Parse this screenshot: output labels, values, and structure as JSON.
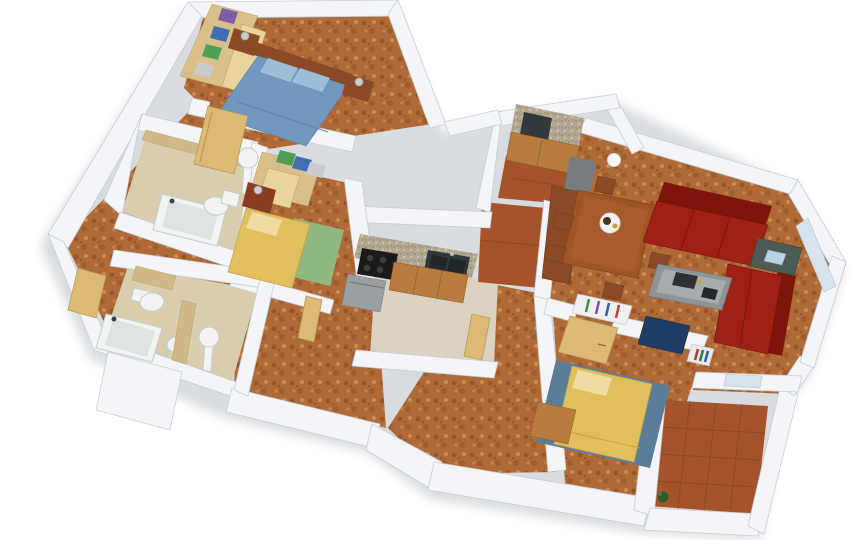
{
  "meta": {
    "title": "3D apartment floor plan - isometric render",
    "type": "architectural-3d-floorplan",
    "background": "#ffffff",
    "view": "top-down isometric with perspective",
    "walls": "white with soft gray shading",
    "flooring": "cork in halls and bedrooms, terracotta on balcony and pantry, beige tile in kitchen and bathrooms"
  },
  "palette": {
    "wall": "#f3f5f8",
    "wall_shade": "#dfe4ea",
    "wall_edge": "#c7ced6",
    "cork": "#b06a38",
    "terracotta": "#a5532b",
    "terracotta_grout": "#7e3c1c",
    "tile_beige": "#dbd2c1",
    "bath_floor": "#d8cdae",
    "tan_wall": "#cfba85",
    "door_wood": "#dcba76",
    "wardrobe_wood": "#d8c08a",
    "bed_blue": "#7097bd",
    "pillow_blue": "#9fbcd8",
    "headboard": "#8a4a26",
    "bed_yellow": "#e2bf5e",
    "pillow_yellow": "#eedca2",
    "rug_green": "#90b87e",
    "rug_blue": "#5a7d9a",
    "sofa_red": "#9e2113",
    "sofa_red_dark": "#7e150a",
    "wood_mid": "#a05527",
    "wood_dark": "#8a4a26",
    "cabinet_wood": "#b87c3e",
    "granite": "#b3a88f",
    "cooktop": "#1b1b1b",
    "sink_dark": "#30383b",
    "appliance": "#9aa0a2",
    "fixture": "#f2f4f4",
    "fixture_edge": "#c6cccc",
    "navy": "#1f3c63",
    "gray_table": "#8e9396",
    "corner_table": "#4e5a54",
    "plant": "#2f5c2b",
    "lamp_metal": "#c9ced2",
    "shadow": "#b9bfc7",
    "clothes_purple": "#7b5ea6",
    "clothes_blue": "#3f6fae",
    "clothes_green": "#4e9e55",
    "clothes_white": "#c8ccd0"
  },
  "rooms": [
    {
      "name": "master-bedroom",
      "position": "top-left",
      "furniture": [
        "double bed with blue duvet and two pillows",
        "wooden headboard",
        "two wooden nightstands with metal lamps",
        "open wardrobe with stacks of folded clothes",
        "open wooden door to hallway"
      ]
    },
    {
      "name": "bathroom-1",
      "position": "center-left",
      "furniture": [
        "bathtub with dark faucet",
        "toilet with tank",
        "round pedestal sink",
        "tan tiled wall"
      ]
    },
    {
      "name": "bathroom-2",
      "position": "bottom-left",
      "furniture": [
        "bathtub",
        "toilet with tank",
        "bidet",
        "round pedestal sink",
        "tan partition wall"
      ]
    },
    {
      "name": "kids-bedroom",
      "position": "center-left",
      "furniture": [
        "single bed with yellow cover and pillow",
        "green rug",
        "wardrobe with folded clothes",
        "red-brown bedside cabinet with lamp"
      ]
    },
    {
      "name": "kitchen",
      "position": "center",
      "furniture": [
        "granite counter",
        "black four-burner cooktop",
        "dark double sink",
        "wooden base cabinets",
        "gray appliance",
        "beige tile floor"
      ]
    },
    {
      "name": "utility-kitchenette",
      "position": "top-center",
      "furniture": [
        "granite counter with dark sink",
        "wooden base cabinets",
        "terracotta tile floor"
      ]
    },
    {
      "name": "living-dining-room",
      "position": "right",
      "furniture": [
        "wooden dining table with six chairs",
        "dinner plate with food",
        "tall wooden sideboard",
        "gray cabinet",
        "two brick-red sofas in L arrangement",
        "gray coffee table with books and figurine",
        "dark corner table with light-blue magazine",
        "wall clock",
        "white globe wall lamp",
        "two blue vases",
        "windows on east and south walls"
      ]
    },
    {
      "name": "bedroom-2",
      "position": "bottom-center",
      "furniture": [
        "single bed with yellow cover on blue rug",
        "wooden dresser",
        "wardrobe shelf with colored markers",
        "tan wardrobe door",
        "navy desk",
        "small bookshelf with books"
      ]
    },
    {
      "name": "balcony",
      "position": "bottom-right",
      "furniture": [
        "terracotta tile grid floor",
        "white parapet walls",
        "small green plant in corner"
      ]
    },
    {
      "name": "hallway",
      "position": "left-and-center",
      "furniture": [
        "cork flooring",
        "open tan wooden doors",
        "entrance door on west wall"
      ]
    }
  ]
}
